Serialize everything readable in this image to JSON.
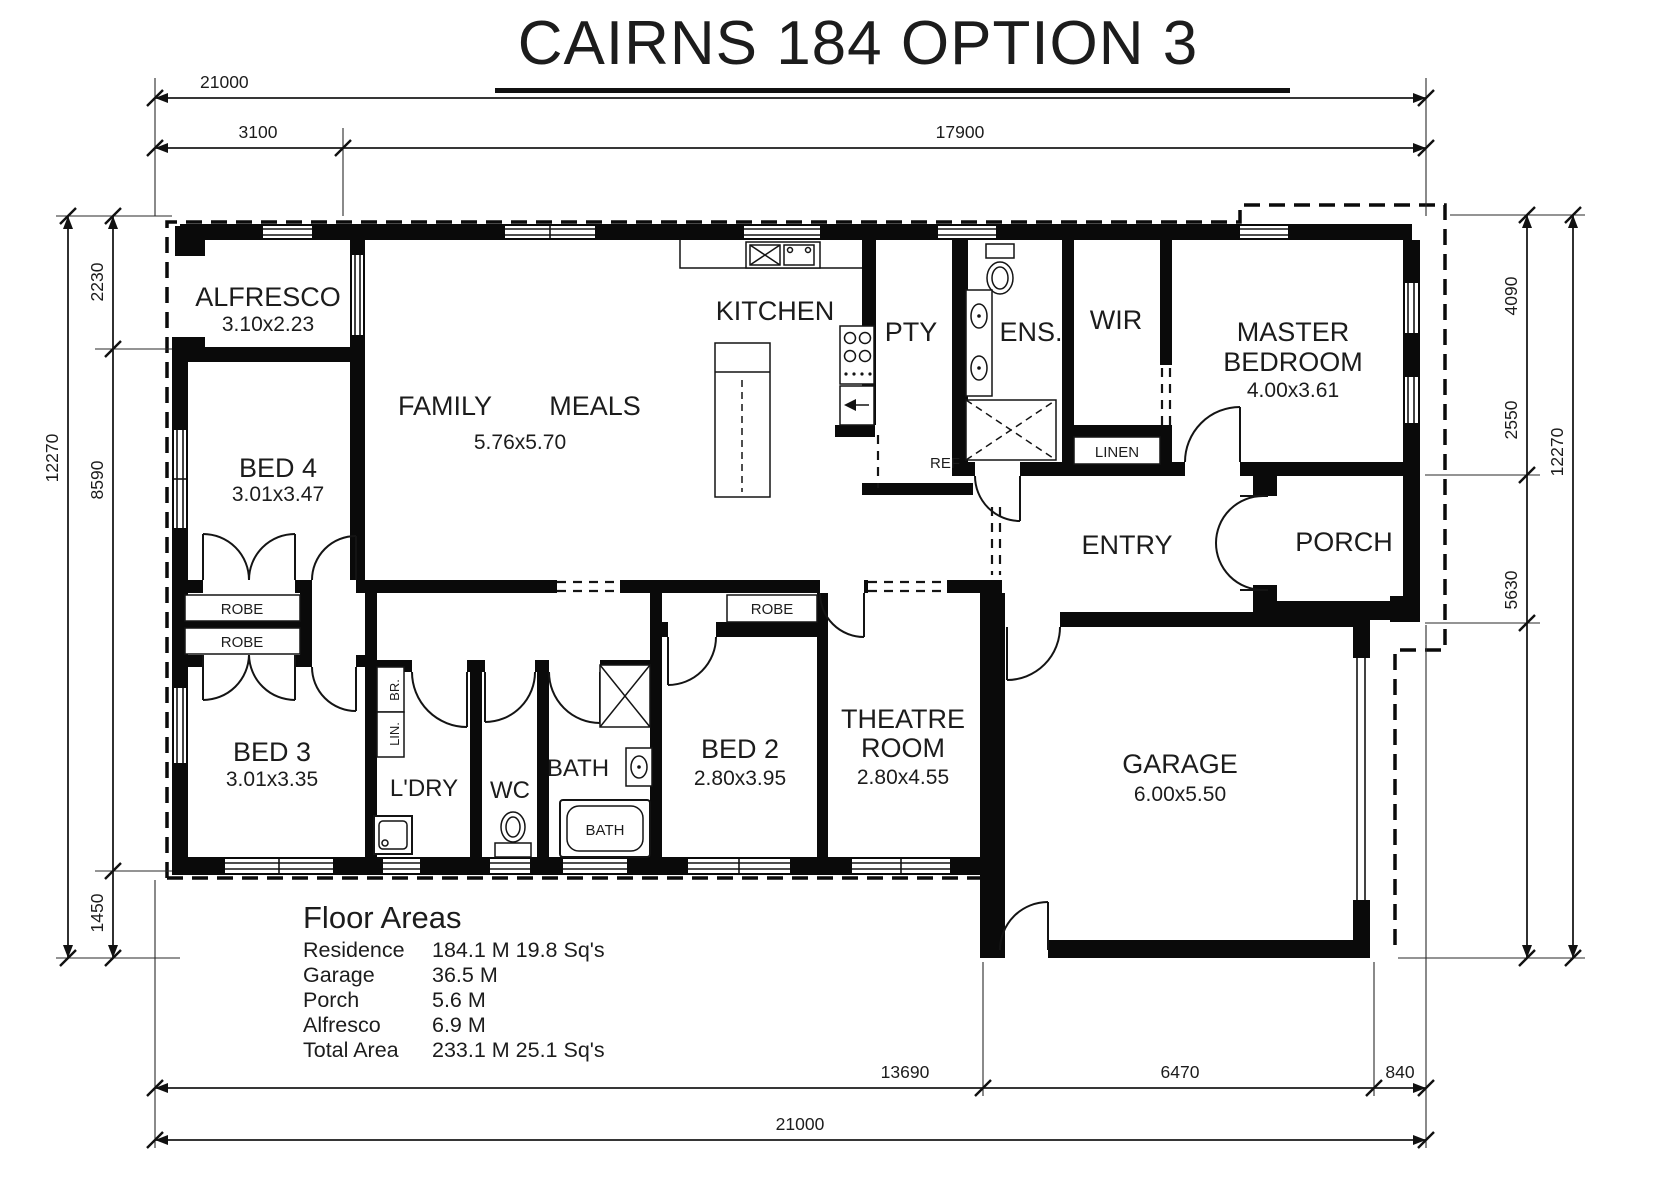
{
  "title": "CAIRNS 184 OPTION 3",
  "rooms": {
    "alfresco": {
      "name": "ALFRESCO",
      "size": "3.10x2.23"
    },
    "bed4": {
      "name": "BED 4",
      "size": "3.01x3.47"
    },
    "bed3": {
      "name": "BED 3",
      "size": "3.01x3.35"
    },
    "family": {
      "name": "FAMILY"
    },
    "meals": {
      "name": "MEALS"
    },
    "living_size": "5.76x5.70",
    "kitchen": {
      "name": "KITCHEN"
    },
    "pty": {
      "name": "PTY"
    },
    "ens": {
      "name": "ENS."
    },
    "wir": {
      "name": "WIR"
    },
    "master": {
      "line1": "MASTER",
      "line2": "BEDROOM",
      "size": "4.00x3.61"
    },
    "entry": {
      "name": "ENTRY"
    },
    "porch": {
      "name": "PORCH"
    },
    "linen": {
      "name": "LINEN"
    },
    "ref": {
      "name": "REF"
    },
    "robe_bed4": {
      "name": "ROBE"
    },
    "robe_bed3": {
      "name": "ROBE"
    },
    "robe_bed2": {
      "name": "ROBE"
    },
    "br": {
      "name": "BR."
    },
    "lin": {
      "name": "LIN."
    },
    "ldry": {
      "name": "L'DRY"
    },
    "wc": {
      "name": "WC"
    },
    "bath": {
      "name": "BATH"
    },
    "bath_tub": {
      "name": "BATH"
    },
    "bed2": {
      "name": "BED 2",
      "size": "2.80x3.95"
    },
    "theatre": {
      "line1": "THEATRE",
      "line2": "ROOM",
      "size": "2.80x4.55"
    },
    "garage": {
      "name": "GARAGE",
      "size": "6.00x5.50"
    }
  },
  "dimensions": {
    "top": {
      "total": "21000",
      "seg1": "3100",
      "seg2": "17900"
    },
    "bottom": {
      "seg1": "13690",
      "seg2": "6470",
      "seg3": "840",
      "total": "21000"
    },
    "left": {
      "seg1": "2230",
      "seg2": "8590",
      "seg3": "1450",
      "total": "12270"
    },
    "right": {
      "seg1": "4090",
      "seg2": "2550",
      "seg3": "5630",
      "total": "12270"
    }
  },
  "floor_areas": {
    "heading": "Floor Areas",
    "rows": [
      {
        "label": "Residence",
        "value": "184.1 M 19.8 Sq's"
      },
      {
        "label": "Garage",
        "value": "36.5 M"
      },
      {
        "label": "Porch",
        "value": "5.6 M"
      },
      {
        "label": "Alfresco",
        "value": "6.9 M"
      },
      {
        "label": "Total Area",
        "value": "233.1 M 25.1 Sq's"
      }
    ]
  }
}
